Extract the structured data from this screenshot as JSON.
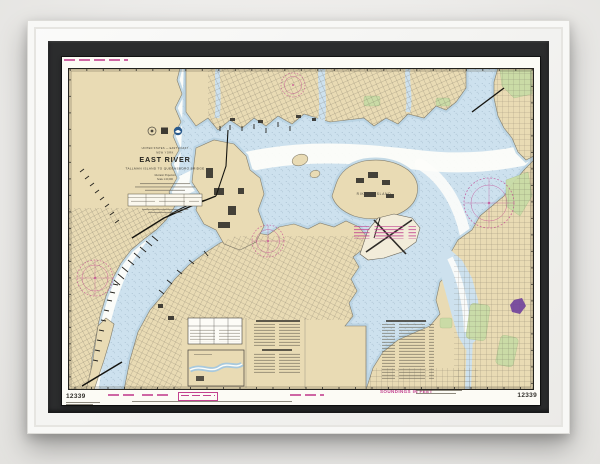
{
  "chart": {
    "number": "12339",
    "soundings_label": "SOUNDINGS IN FEET",
    "title_block": {
      "region": "UNITED STATES — EAST COAST",
      "state": "NEW YORK",
      "title": "EAST RIVER",
      "subtitle": "TALLMAN ISLAND TO QUEENSBORO BRIDGE",
      "projection": "Mercator Projection",
      "scale": "Scale 1:20,000"
    },
    "map_labels": {
      "rikers": "RIKERS ISLAND"
    },
    "icons": [
      "commerce-seal-icon",
      "flag-seal-icon",
      "noaa-logo-icon"
    ],
    "colors": {
      "wall": "#ecebe9",
      "frame": "#f6f6f4",
      "mat": "#2b2c2d",
      "paper": "#fcfbf5",
      "land": "#e9dbb4",
      "water": "#cde1ee",
      "channel_white": "#fdfdf9",
      "park_green": "#c9dca6",
      "noaa_magenta": "#c2418f",
      "marina_purple": "#6f3f9b"
    }
  }
}
